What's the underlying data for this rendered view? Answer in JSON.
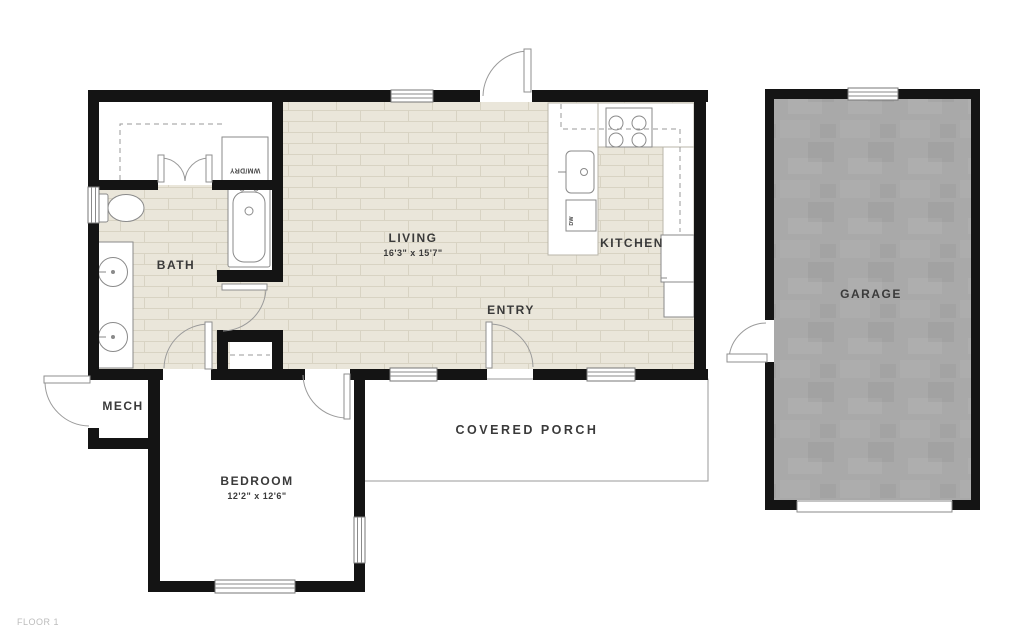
{
  "plan": {
    "floor_tag": "FLOOR 1",
    "rooms": {
      "living": {
        "name": "LIVING",
        "dims": "16'3\" x 15'7\""
      },
      "kitchen": {
        "name": "KITCHEN"
      },
      "entry": {
        "name": "ENTRY"
      },
      "bath": {
        "name": "BATH"
      },
      "mech": {
        "name": "MECH"
      },
      "bedroom": {
        "name": "BEDROOM",
        "dims": "12'2\" x 12'6\""
      },
      "covered_porch": {
        "name": "COVERED PORCH"
      },
      "garage": {
        "name": "GARAGE"
      }
    },
    "fixtures": {
      "washer_dryer": "WM/DRY",
      "dishwasher": "DW"
    },
    "colors": {
      "wall": "#141414",
      "tile_floor": "#eae6da",
      "tile_line": "#d8d3c3",
      "garage_floor": "#a9a9a9",
      "fixture_outline": "#8a8a8a",
      "label_text": "#3a3a3a",
      "floor_tag_text": "#bcbcbc"
    }
  }
}
